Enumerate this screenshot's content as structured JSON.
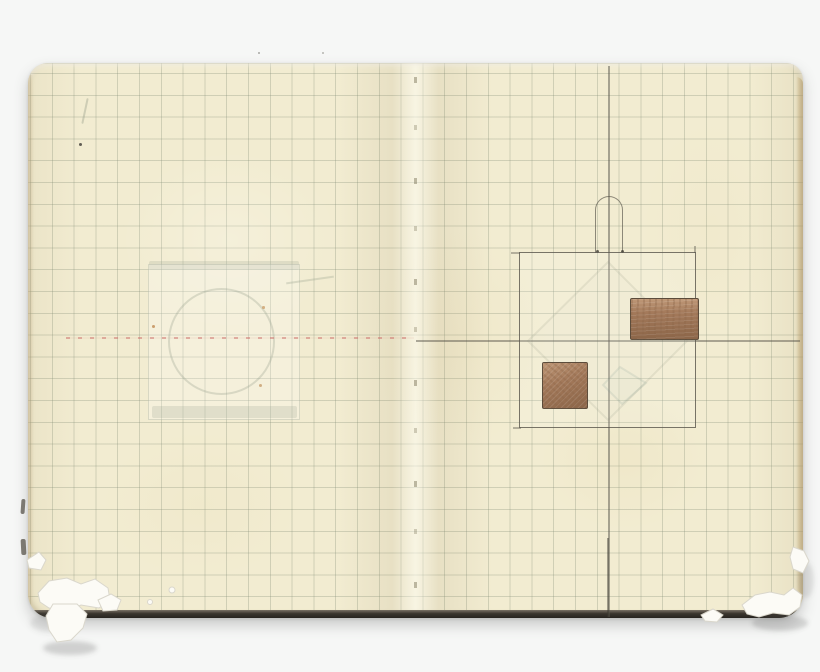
{
  "scene": {
    "type": "scanned open squared-paper notebook",
    "background_color": "#f6f7f6"
  },
  "colors": {
    "background": "#f6f7f6",
    "page": "#f2ecd1",
    "grid_line": "rgba(116,128,108,0.27)",
    "pencil": "rgba(88,84,74,0.8)",
    "red_dash": "rgba(205,115,110,0.55)",
    "ghost_line": "rgba(150,158,138,0.30)",
    "copper": "#a3795a",
    "copper_light": "#bf9877",
    "copper_dark": "#8c6649",
    "torn_paper": "#fcfbf6",
    "cover_edge_dark": "#27241f",
    "page_edge_tan": "rgba(160,130,75,0.45)"
  },
  "notebook": {
    "spread_px": {
      "left": 28,
      "top": 63,
      "width": 775,
      "height": 555
    },
    "grid_spacing_px": 21.8,
    "spine_x": 415,
    "damage": [
      "torn bottom-left corner with hanging paper flap",
      "chipped bottom-right corner"
    ]
  },
  "left_page": {
    "ghost": {
      "label": "faint bleed-through of square with inscribed circle",
      "square_px": {
        "left": 148,
        "top": 264,
        "width": 152,
        "height": 156
      },
      "circle_px": {
        "left": 168,
        "top": 288,
        "width": 107,
        "height": 107
      },
      "top_band_px": {
        "left": 149,
        "top": 261,
        "width": 150,
        "height": 9
      },
      "bottom_band_px": {
        "left": 152,
        "top": 406,
        "width": 145,
        "height": 12
      },
      "arc_px": {
        "left": 286,
        "top": 279,
        "width": 48,
        "height": 2
      }
    },
    "red_dash_line_px": {
      "left": 66,
      "top": 337,
      "width": 348,
      "height": 2
    }
  },
  "right_page": {
    "lines": {
      "vertical_px": {
        "left": 608,
        "top": 66,
        "width": 1.5,
        "height": 551
      },
      "horizontal_px": {
        "left": 416,
        "top": 340,
        "width": 384,
        "height": 1.5
      }
    },
    "sketch": {
      "label": "pencil square vessel with rounded arch handle and two copper-shaded rectangles",
      "square_px": {
        "left": 519,
        "top": 252,
        "width": 177,
        "height": 176
      },
      "arch_px": {
        "left": 595,
        "top": 196,
        "width": 28,
        "height": 57
      },
      "copper_rects_px": [
        {
          "left": 630,
          "top": 298,
          "width": 69,
          "height": 42
        },
        {
          "left": 542,
          "top": 362,
          "width": 46,
          "height": 47
        }
      ]
    }
  }
}
